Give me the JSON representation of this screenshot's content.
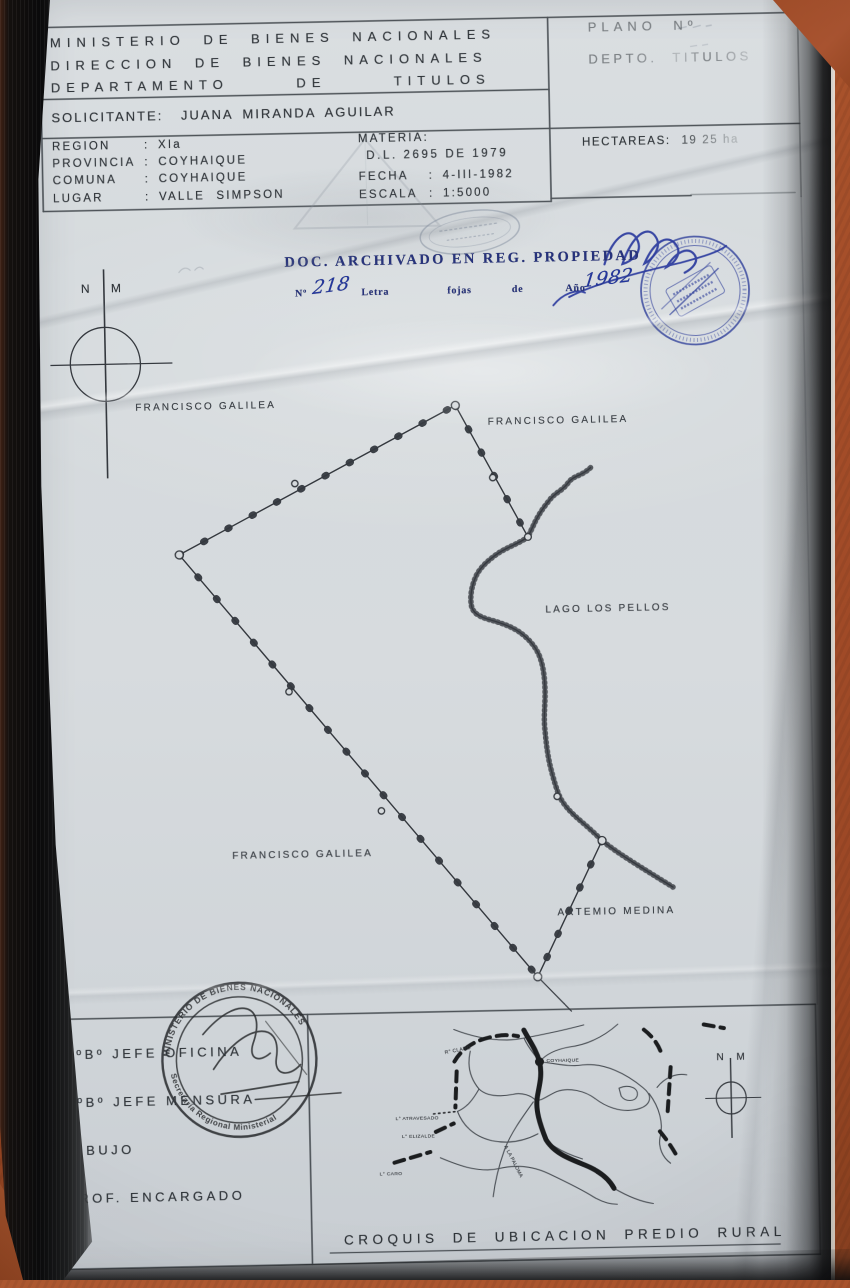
{
  "header": {
    "ministry_lines": [
      "MINISTERIO DE BIENES NACIONALES",
      "DIRECCION DE BIENES NACIONALES",
      "DEPARTAMENTO DE TITULOS"
    ],
    "solicitante": {
      "label": "SOLICITANTE",
      "value": "JUANA MIRANDA AGUILAR"
    },
    "location_rows": [
      {
        "label": "REGION",
        "value": "XIa"
      },
      {
        "label": "PROVINCIA",
        "value": "COYHAIQUE"
      },
      {
        "label": "COMUNA",
        "value": "COYHAIQUE"
      },
      {
        "label": "LUGAR",
        "value": "VALLE SIMPSON"
      }
    ],
    "materia": {
      "label": "MATERIA",
      "value": "D.L. 2695 DE 1979"
    },
    "fecha": {
      "label": "FECHA",
      "value": "4-III-1982"
    },
    "escala": {
      "label": "ESCALA",
      "value": "1:5000"
    },
    "plano": {
      "label": "PLANO Nº"
    },
    "depto": {
      "label": "DEPTO. TITULOS"
    },
    "hectareas": {
      "label": "HECTAREAS",
      "value": "19 25 ha"
    }
  },
  "registry_note": {
    "title": "DOC. ARCHIVADO EN REG. PROPIEDAD",
    "numero_label": "Nº",
    "numero_value": "218",
    "letra_label": "Letra",
    "fojas_label": "fojas",
    "de_label": "de",
    "ano_label": "Año",
    "ano_value": "1982"
  },
  "plan": {
    "north": {
      "n": "N",
      "m": "M"
    },
    "neighbor_labels": {
      "northwest": "FRANCISCO GALILEA",
      "northeast": "FRANCISCO GALILEA",
      "southwest": "FRANCISCO GALILEA",
      "southeast": "ARTEMIO MEDINA"
    },
    "lake_label": "LAGO LOS PELLOS"
  },
  "stamps": {
    "regional_seal": {
      "arc_top": "MINISTERIO DE BIENES NACIONALES",
      "arc_bottom": "Secretaría Regional Ministerial"
    }
  },
  "signature_block": {
    "rows": [
      "VºBº JEFE OFICINA",
      "VºBº JEFE MENSURA",
      "DIBUJO",
      "PROF. ENCARGADO"
    ]
  },
  "croquis": {
    "title": "CROQUIS DE UBICACION PREDIO RURAL",
    "north": {
      "n": "N",
      "m": "M"
    },
    "labels": {
      "rio_claro": "R° CLARO",
      "city": "COYHAIQUE",
      "lago_atravesado": "L° ATRAVESADO",
      "lago_elizalde": "L° ELIZALDE",
      "lago_caro": "L° CARO",
      "road_paloma": "A LA PALOMA"
    }
  },
  "punct": {
    "colon": ":"
  },
  "colors": {
    "paper": "#d6dadd",
    "ink": "#34383e",
    "stamp_blue": "#2e3e9a",
    "background_orange": "#a8502b"
  }
}
